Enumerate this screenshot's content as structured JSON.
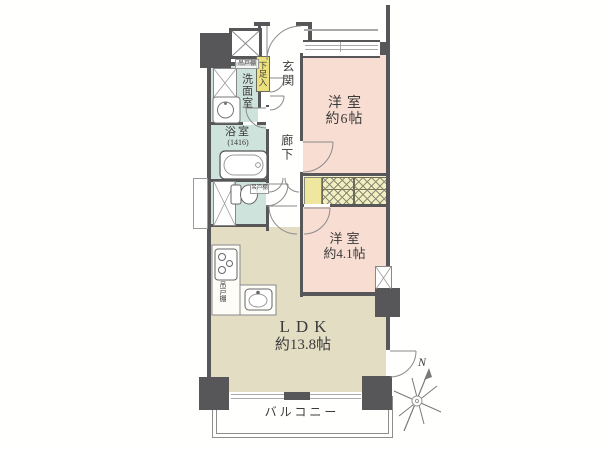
{
  "plan_title": "floor-plan",
  "rooms": {
    "bedroom6": {
      "name": "洋室",
      "size": "約6帖"
    },
    "bedroom41": {
      "name": "洋室",
      "size": "約4.1帖"
    },
    "ldk": {
      "name": "LDK",
      "size": "約13.8帖"
    },
    "entrance": {
      "name": "玄関"
    },
    "hallway": {
      "name": "廊下"
    },
    "washroom": {
      "name": "洗面室"
    },
    "bathroom": {
      "name": "浴室",
      "size": "(1416)"
    },
    "balcony": {
      "name": "バルコニー"
    },
    "shoe_cabinet": {
      "name": "下足入"
    },
    "cupboard_washroom": {
      "name": "吊戸棚"
    },
    "cupboard_toilet": {
      "name": "吊戸棚"
    },
    "cupboard_kitchen": {
      "name": "吊戸棚"
    }
  },
  "compass": {
    "north_label": "N"
  },
  "icons": {
    "bathtub": "bathtub-icon",
    "toilet": "toilet-icon",
    "stove": "stove-icon",
    "kitchen_sink": "kitchen-sink-icon",
    "wash_basin": "wash-basin-icon",
    "washer_space": "crossed-box-icon",
    "elevator_shaft": "crossed-box-icon",
    "pipe_space": "crossed-box-icon",
    "compass": "compass-rose-icon"
  },
  "colors": {
    "wall": "#57575a",
    "bedroom": "#f8ddd3",
    "ldk": "#e3ddc3",
    "wet_area": "#cfe3dd",
    "closet": "#f4f2cc",
    "closet_box": "#efe79d",
    "cabinet_yellow": "#ece07c"
  }
}
